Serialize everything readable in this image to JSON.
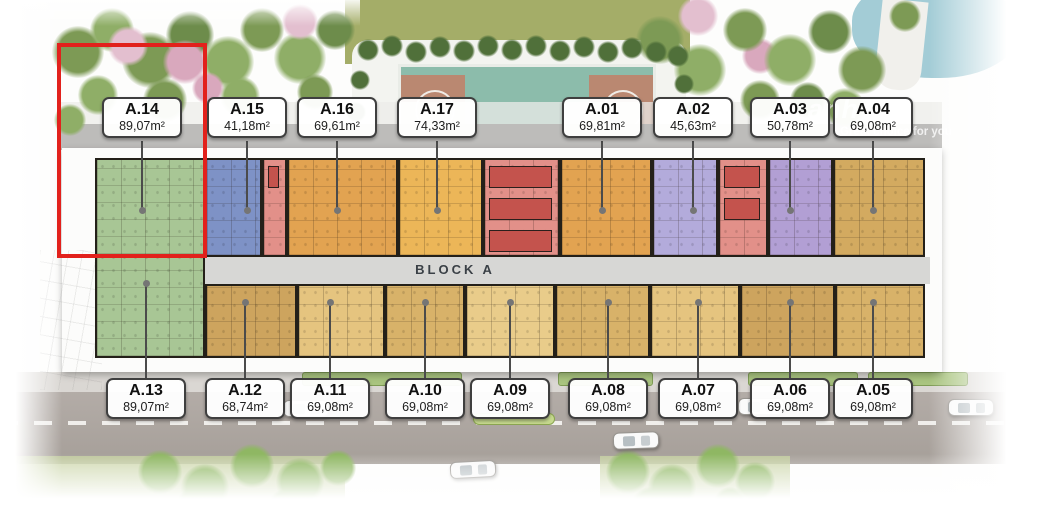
{
  "plan": {
    "block_label": "BLOCK A",
    "watermark": {
      "logo_fragment": "anh",
      "tagline": "Great choice for you"
    },
    "highlight": {
      "unit": "A.14",
      "color": "#e2211c"
    },
    "corridor_color": "#d7d7d5",
    "core_color": "#e29089",
    "elevator_color": "#c4534d",
    "units_top": [
      {
        "id": "A.14",
        "area": "89,07m²",
        "color": "#a8c695",
        "highlighted": true
      },
      {
        "id": "A.15",
        "area": "41,18m²",
        "color": "#7e92c6"
      },
      {
        "id": "A.16",
        "area": "69,61m²",
        "color": "#e2a351"
      },
      {
        "id": "A.17",
        "area": "74,33m²",
        "color": "#ecb658"
      },
      {
        "id": "A.01",
        "area": "69,81m²",
        "color": "#e2a351"
      },
      {
        "id": "A.02",
        "area": "45,63m²",
        "color": "#b3abdb"
      },
      {
        "id": "A.03",
        "area": "50,78m²",
        "color": "#b29fd4"
      },
      {
        "id": "A.04",
        "area": "69,08m²",
        "color": "#d3aa60"
      }
    ],
    "units_bottom": [
      {
        "id": "A.13",
        "area": "89,07m²",
        "color": "#a8c695"
      },
      {
        "id": "A.12",
        "area": "68,74m²",
        "color": "#cda45e"
      },
      {
        "id": "A.11",
        "area": "69,08m²",
        "color": "#e5c47f"
      },
      {
        "id": "A.10",
        "area": "69,08m²",
        "color": "#d8b269"
      },
      {
        "id": "A.09",
        "area": "69,08m²",
        "color": "#e9cc8a"
      },
      {
        "id": "A.08",
        "area": "69,08m²",
        "color": "#d8b269"
      },
      {
        "id": "A.07",
        "area": "69,08m²",
        "color": "#e5c47f"
      },
      {
        "id": "A.06",
        "area": "69,08m²",
        "color": "#cda45e"
      },
      {
        "id": "A.05",
        "area": "69,08m²",
        "color": "#d8b269"
      }
    ]
  }
}
